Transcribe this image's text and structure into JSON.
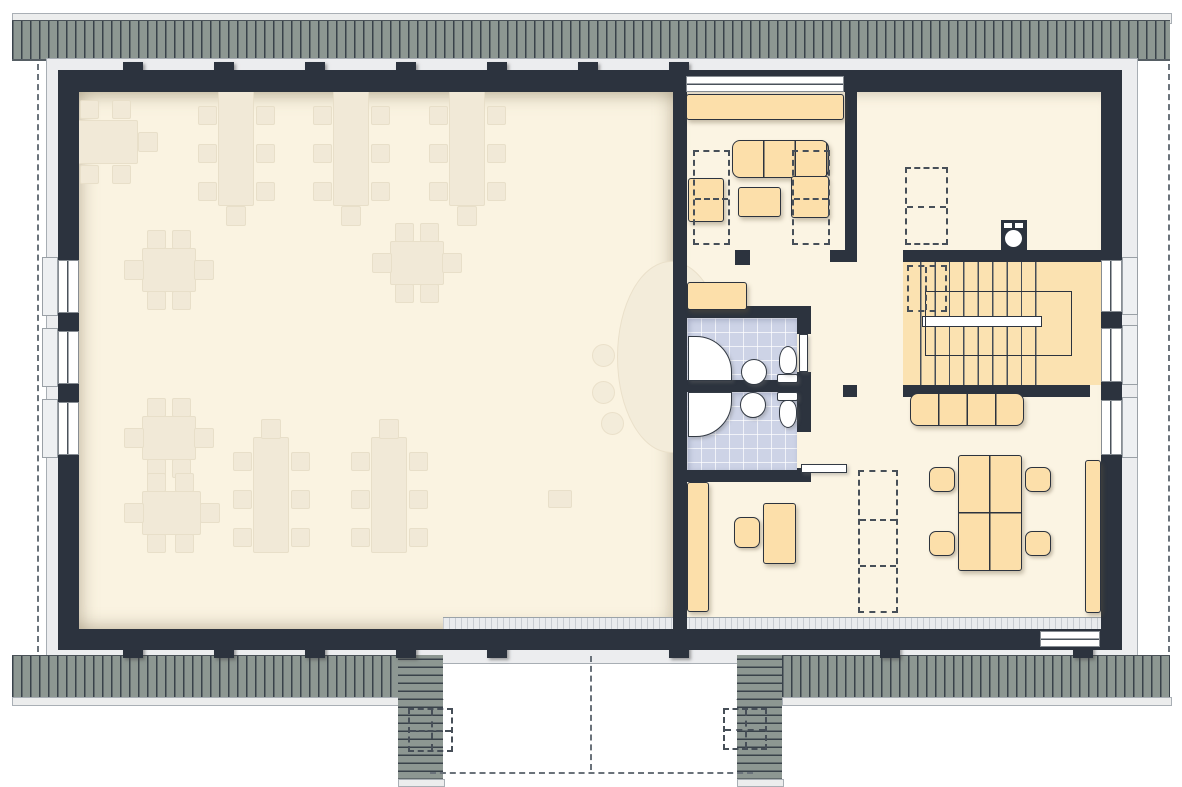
{
  "plan_type": "floor-plan-attic-storey",
  "rooms": [
    {
      "id": "2.1",
      "label": "2.1",
      "x": 865,
      "y": 352
    },
    {
      "id": "2.2",
      "label": "2.2",
      "x": 984,
      "y": 122
    },
    {
      "id": "2.3",
      "label": "2.3",
      "x": 900,
      "y": 453
    },
    {
      "id": "2.4",
      "label": "2.4",
      "x": 750,
      "y": 449
    },
    {
      "id": "2.5",
      "label": "2.5",
      "x": 752,
      "y": 334
    },
    {
      "id": "2.6",
      "label": "2.6",
      "x": 764,
      "y": 233
    }
  ],
  "colors": {
    "wall": "#2c333e",
    "roof": "#8d9792",
    "roof_line": "#39424a",
    "floor_hall": "#faf3e1",
    "floor_wing": "#fbf4e3",
    "furniture_faint": "#f1e9d7",
    "furniture_orange": "#fcdfaa",
    "stairs": "#fbe2b1",
    "bathroom_tile": "#cdd3e6",
    "label_text": "#3d444c",
    "fixture_white": "#ffffff"
  },
  "geometry": {
    "roof": {
      "top_edge": [
        12,
        13,
        1158,
        9
      ],
      "top_band": [
        12,
        20,
        1158,
        38
      ],
      "bottom_band_left": [
        12,
        655,
        386,
        43
      ],
      "bottom_band_right": [
        782,
        655,
        388,
        43
      ],
      "bottom_edge_left": [
        12,
        697,
        386,
        7
      ],
      "bottom_edge_right": [
        782,
        697,
        388,
        7
      ],
      "cheek_left": [
        398,
        655,
        45,
        125
      ],
      "cheek_right": [
        737,
        655,
        45,
        125
      ],
      "cheek_edge_left": [
        398,
        779,
        45,
        6
      ],
      "cheek_edge_right": [
        737,
        779,
        45,
        6
      ],
      "fascia": [
        46,
        58,
        1090,
        604
      ]
    },
    "floors": {
      "hall": [
        79,
        92,
        594,
        537
      ],
      "wing": [
        687,
        92,
        414,
        537
      ],
      "tile_25": [
        687,
        318,
        110,
        62
      ],
      "tile_24": [
        687,
        392,
        110,
        78
      ],
      "stairwell": [
        903,
        262,
        198,
        123
      ],
      "knee_glazing": [
        443,
        617,
        658,
        13
      ]
    },
    "walls": [
      [
        58,
        70,
        1064,
        22
      ],
      [
        58,
        629,
        1064,
        21
      ],
      [
        58,
        70,
        21,
        580
      ],
      [
        1101,
        70,
        21,
        580
      ],
      [
        673,
        70,
        14,
        580
      ],
      [
        845,
        70,
        12,
        180
      ],
      [
        903,
        250,
        198,
        12
      ],
      [
        830,
        250,
        27,
        12
      ],
      [
        735,
        250,
        15,
        15
      ],
      [
        673,
        306,
        138,
        12
      ],
      [
        673,
        380,
        138,
        12
      ],
      [
        673,
        470,
        138,
        12
      ],
      [
        797,
        306,
        14,
        28
      ],
      [
        797,
        372,
        14,
        20
      ],
      [
        797,
        392,
        14,
        40
      ],
      [
        797,
        468,
        14,
        14
      ],
      [
        843,
        385,
        14,
        12
      ],
      [
        903,
        385,
        187,
        12
      ]
    ],
    "pilasters": {
      "top_centers": [
        133,
        224,
        315,
        406,
        497,
        588,
        679
      ],
      "top_y": 62,
      "bottom_centers": [
        133,
        224,
        315,
        406,
        497,
        679,
        890,
        1083
      ],
      "bottom_y": 624,
      "size": [
        20,
        34
      ]
    },
    "windows": {
      "left": [
        [
          58,
          260,
          21,
          53
        ],
        [
          58,
          331,
          21,
          53
        ],
        [
          58,
          402,
          21,
          53
        ]
      ],
      "left_sills": [
        [
          42,
          257,
          16,
          59
        ],
        [
          42,
          328,
          16,
          59
        ],
        [
          42,
          399,
          16,
          59
        ]
      ],
      "right": [
        [
          1101,
          260,
          21,
          52
        ],
        [
          1101,
          328,
          21,
          54
        ],
        [
          1101,
          400,
          21,
          55
        ]
      ],
      "right_sills": [
        [
          1122,
          257,
          16,
          58
        ],
        [
          1122,
          325,
          16,
          60
        ],
        [
          1122,
          397,
          16,
          61
        ]
      ],
      "top_26": [
        686,
        76,
        158,
        16
      ],
      "bottom_23": [
        1040,
        631,
        60,
        16
      ]
    },
    "hall_furniture": {
      "tables_v_top": {
        "cx": [
          235,
          350,
          466
        ],
        "y": 88
      },
      "tables_v_bottom": {
        "cx": [
          270,
          388
        ],
        "y": 437
      },
      "tables_cross": [
        [
          168,
          269
        ],
        [
          416,
          262
        ],
        [
          168,
          437
        ]
      ],
      "table_h_topleft": [
        75,
        120,
        61,
        42
      ],
      "table_h_bottomleft": [
        142,
        491,
        57,
        42
      ],
      "stage_ellipse": [
        617,
        261,
        106,
        190
      ],
      "stage_stools": [
        [
          592,
          344,
          21
        ],
        [
          592,
          381,
          21
        ],
        [
          601,
          412,
          21
        ]
      ],
      "stage_box": [
        548,
        490,
        22,
        16
      ]
    },
    "wing_furniture": [
      {
        "name": "window-seat-2-6",
        "cls": "orange",
        "r": [
          686,
          94,
          158,
          26
        ]
      },
      {
        "name": "sofa-2-6-horizontal",
        "cls": "orange seams3",
        "r": [
          732,
          140,
          97,
          38
        ]
      },
      {
        "name": "sofa-2-6-vertical",
        "cls": "orange",
        "r": [
          791,
          176,
          38,
          42
        ]
      },
      {
        "name": "armchair-2-6",
        "cls": "orange",
        "r": [
          688,
          178,
          36,
          44
        ]
      },
      {
        "name": "coffee-table-2-6",
        "cls": "orange",
        "r": [
          738,
          187,
          43,
          30
        ]
      },
      {
        "name": "cabinet-2-6",
        "cls": "orange",
        "r": [
          687,
          282,
          60,
          28
        ]
      },
      {
        "name": "sofa-2-3",
        "cls": "orange seams4",
        "r": [
          910,
          393,
          114,
          33
        ]
      },
      {
        "name": "conference-table-2-3",
        "cls": "orange crossLines",
        "r": [
          958,
          455,
          64,
          116
        ]
      },
      {
        "name": "chair-2-3",
        "cls": "chairO",
        "r": [
          929,
          467,
          26,
          25
        ]
      },
      {
        "name": "chair-2-3",
        "cls": "chairO",
        "r": [
          929,
          531,
          26,
          25
        ]
      },
      {
        "name": "chair-2-3",
        "cls": "chairO",
        "r": [
          1025,
          467,
          26,
          25
        ]
      },
      {
        "name": "chair-2-3",
        "cls": "chairO",
        "r": [
          1025,
          531,
          26,
          25
        ]
      },
      {
        "name": "cabinet-2-3-right",
        "cls": "orange",
        "r": [
          1085,
          460,
          16,
          153
        ]
      },
      {
        "name": "cabinet-2-3-left",
        "cls": "orange",
        "r": [
          687,
          482,
          22,
          130
        ]
      },
      {
        "name": "desk-2-3",
        "cls": "orange",
        "r": [
          763,
          503,
          33,
          61
        ]
      },
      {
        "name": "desk-chair-2-3",
        "cls": "chairO",
        "r": [
          734,
          517,
          26,
          31
        ]
      }
    ],
    "fixtures": [
      {
        "name": "shower-icon",
        "r": [
          688,
          336,
          44,
          45
        ],
        "radius": "0 36px 0 0"
      },
      {
        "name": "shower-icon",
        "r": [
          688,
          392,
          44,
          45
        ],
        "radius": "0 0 36px 0"
      },
      {
        "name": "sink-icon",
        "r": [
          741,
          359,
          26,
          26
        ],
        "radius": "50%"
      },
      {
        "name": "sink-icon",
        "r": [
          740,
          392,
          26,
          26
        ],
        "radius": "50%"
      },
      {
        "name": "toilet-tank-icon",
        "r": [
          777,
          374,
          21,
          9
        ],
        "radius": "2px"
      },
      {
        "name": "toilet-bowl-icon",
        "r": [
          779,
          346,
          18,
          28
        ],
        "radius": "50% 50% 40% 40%"
      },
      {
        "name": "toilet-tank-icon",
        "r": [
          777,
          392,
          21,
          9
        ],
        "radius": "2px"
      },
      {
        "name": "toilet-bowl-icon",
        "r": [
          779,
          400,
          18,
          28
        ],
        "radius": "40% 40% 50% 50%"
      }
    ],
    "stairs": {
      "treads": [
        920,
        262,
        118,
        123
      ],
      "railing": [
        922,
        316,
        118,
        9
      ],
      "well": [
        925,
        291,
        145,
        63
      ]
    },
    "washer": [
      1001,
      220,
      26,
      32
    ],
    "dashed_rects": [
      {
        "r": [
          693,
          150,
          37,
          95
        ],
        "lines": [
          0.5
        ]
      },
      {
        "r": [
          792,
          150,
          38,
          95
        ],
        "lines": [
          0.5
        ]
      },
      {
        "r": [
          905,
          167,
          43,
          78
        ],
        "lines": [
          0.5
        ]
      },
      {
        "r": [
          907,
          265,
          40,
          47
        ],
        "vlines": [
          0.45
        ]
      },
      {
        "r": [
          858,
          470,
          40,
          143
        ],
        "lines": [
          0.34,
          0.67
        ]
      },
      {
        "r": [
          408,
          708,
          45,
          44
        ],
        "lines": [
          0.5
        ],
        "vlines": [
          0.5
        ]
      },
      {
        "r": [
          723,
          708,
          44,
          42
        ],
        "lines": [
          0.5
        ],
        "vlines": [
          0.5
        ]
      }
    ],
    "dashed_lines": [
      {
        "dir": "v",
        "x": 37,
        "y": 64,
        "len": 588
      },
      {
        "dir": "v",
        "x": 1168,
        "y": 64,
        "len": 588
      },
      {
        "dir": "v",
        "x": 590,
        "y": 656,
        "len": 114
      },
      {
        "dir": "h",
        "x": 430,
        "y": 772,
        "len": 323
      }
    ],
    "arcs": [
      "M746,268 L746,310",
      "M746,268 A42,42 0 0 1 788,310",
      "M777,262 A55,55 0 0 0 832,317",
      "M853,262 A50,50 0 0 0 903,312",
      "M903,397 A46,46 0 0 1 857,443",
      "M811,334 A38,38 0 0 1 849,372",
      "M813,430 A38,38 0 0 1 851,467"
    ],
    "door_leaves": [
      {
        "r": [
          799,
          334,
          9,
          38
        ]
      },
      {
        "r": [
          801,
          464,
          46,
          9
        ]
      }
    ],
    "roof_diagonals": [
      "M398,655 L443,700",
      "M782,655 L737,700"
    ],
    "stair_break": "M921,331 L909,357 L921,383"
  }
}
